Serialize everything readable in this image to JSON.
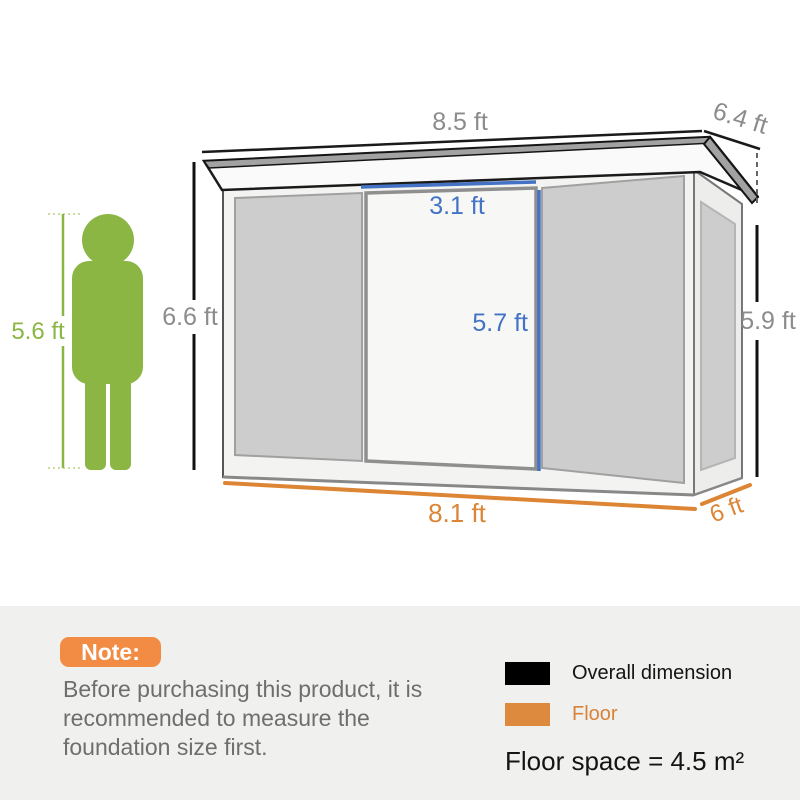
{
  "dimensions": {
    "roof_width": "8.5 ft",
    "roof_depth": "6.4 ft",
    "door_width": "3.1 ft",
    "door_height": "5.7 ft",
    "wall_height_front": "6.6 ft",
    "wall_height_rear": "5.9 ft",
    "person_height": "5.6 ft",
    "floor_width": "8.1 ft",
    "floor_depth": "6 ft"
  },
  "note": {
    "badge": "Note:",
    "text": "Before purchasing this product, it is recommended to measure the foundation size first."
  },
  "legend": {
    "items": [
      {
        "label": "Overall dimension",
        "color": "#000000"
      },
      {
        "label": "Floor",
        "color": "#dd8a3e"
      }
    ],
    "floor_space": "Floor space = 4.5 m²"
  },
  "colors": {
    "overall_dimension_line": "#1a1a1a",
    "floor_line": "#dc8534",
    "door_dimension_line": "#4472c4",
    "person_figure": "#8cb644",
    "dimension_label_gray": "#8c8c8c",
    "note_badge": "#f28c44",
    "note_band_background": "#f0f0ee",
    "shed_panel_gray": "#cdcdcd"
  }
}
